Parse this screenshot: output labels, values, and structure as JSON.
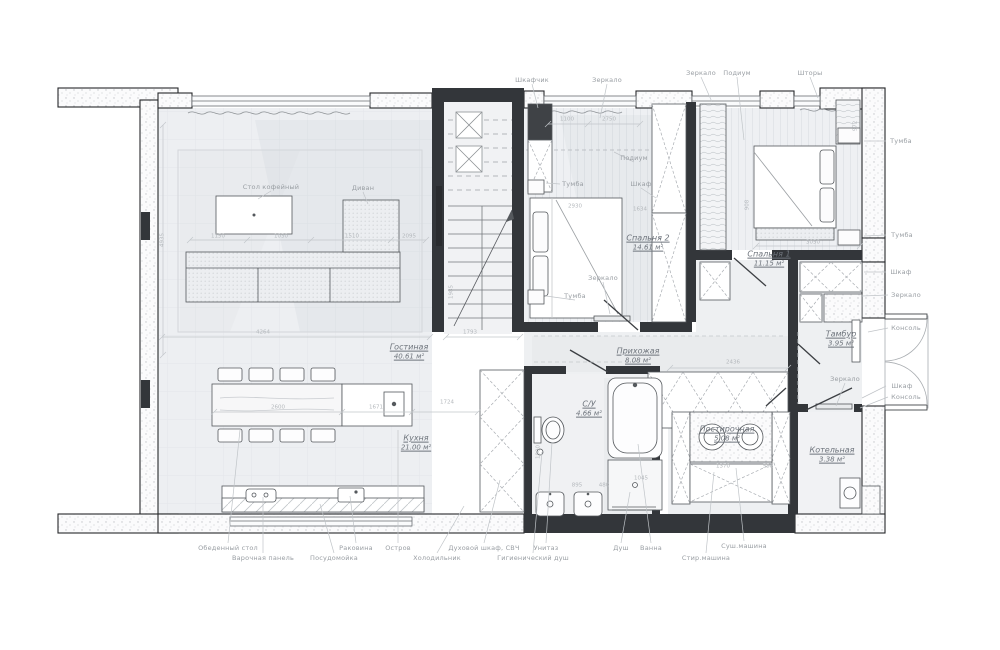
{
  "rooms": [
    {
      "name": "Гостиная",
      "area": "40.61 м²"
    },
    {
      "name": "Кухня",
      "area": "21.00 м²"
    },
    {
      "name": "С/У",
      "area": "4.66 м²"
    },
    {
      "name": "Прихожая",
      "area": "8.08 м²"
    },
    {
      "name": "Спальня 2",
      "area": "14.61 м²"
    },
    {
      "name": "Спальня 1",
      "area": "11.15 м²"
    },
    {
      "name": "Тамбур",
      "area": "3.95 м²"
    },
    {
      "name": "Постирочная",
      "area": "5.08 м²"
    },
    {
      "name": "Котельная",
      "area": "3.38 м²"
    }
  ],
  "callouts": [
    "Шкафчик",
    "Зеркало",
    "Зеркало",
    "Подиум",
    "Шторы",
    "Тумба",
    "Тумба",
    "Шкаф",
    "Зеркало",
    "Консоль",
    "Шкаф",
    "Консоль",
    "Обеденный стол",
    "Варочная панель",
    "Раковина",
    "Посудомойка",
    "Остров",
    "Холодильник",
    "Духовой шкаф, СВЧ",
    "Гигиенический душ",
    "Унитаз",
    "Душ",
    "Ванна",
    "Стир.машина",
    "Суш.машина",
    "Стол кофейный",
    "Диван",
    "Подиум",
    "Тумба",
    "Шкаф",
    "Зеркало",
    "Тумба",
    "Зеркало"
  ],
  "dims": [
    "4264",
    "1793",
    "2600",
    "1671",
    "1724",
    "1150",
    "1030",
    "1510",
    "2095",
    "1100",
    "2750",
    "2930",
    "1634",
    "3050",
    "2436",
    "895",
    "480",
    "1370",
    "558",
    "908",
    "972",
    "1985",
    "4935",
    "1900",
    "1045"
  ],
  "colors": {
    "wall": "#33363a",
    "line": "#54585c",
    "floor": "#edeff2",
    "callout": "#999ea3",
    "dim": "#b4b8bc",
    "room_label": "#6e747c"
  }
}
